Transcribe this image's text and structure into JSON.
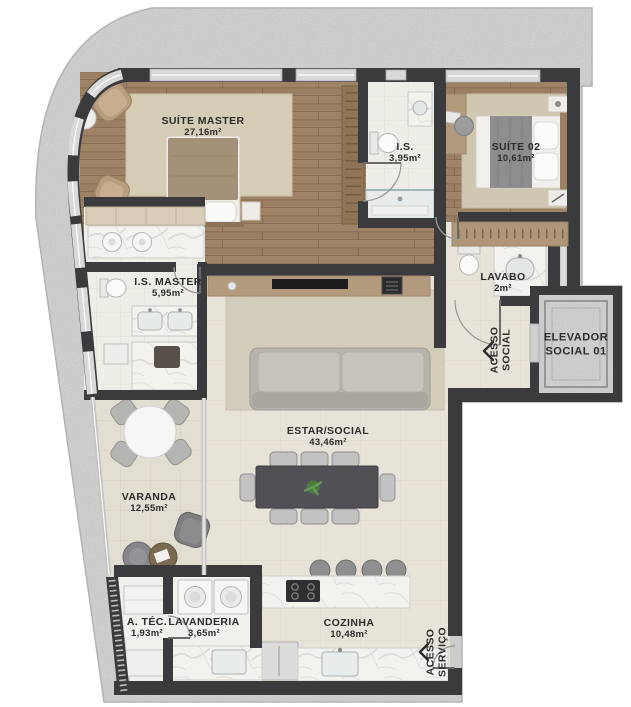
{
  "rooms": {
    "suiteMaster": {
      "name": "SUÍTE MASTER",
      "area": "27,16m²"
    },
    "isSuite": {
      "name": "I.S.",
      "area": "3,95m²"
    },
    "suite02": {
      "name": "SUÍTE 02",
      "area": "10,61m²"
    },
    "isMaster": {
      "name": "I.S. MASTER",
      "area": "5,95m²"
    },
    "lavabo": {
      "name": "LAVABO",
      "area": "2m²"
    },
    "estarSocial": {
      "name": "ESTAR/SOCIAL",
      "area": "43,46m²"
    },
    "varanda": {
      "name": "VARANDA",
      "area": "12,55m²"
    },
    "aTec": {
      "name": "A. TÉC.",
      "area": "1,93m²"
    },
    "lavanderia": {
      "name": "LAVANDERIA",
      "area": "3,65m²"
    },
    "cozinha": {
      "name": "COZINHA",
      "area": "10,48m²"
    }
  },
  "circulation": {
    "elevador": {
      "line1": "ELEVADOR",
      "line2": "SOCIAL 01"
    },
    "acessoSocial": {
      "line1": "ACESSO",
      "line2": "SOCIAL"
    },
    "acessoServico": {
      "line1": "ACESSO",
      "line2": "SERVIÇO"
    }
  },
  "icons": {
    "entry_chevron": "entry-direction-chevron"
  },
  "colors": {
    "wall": "#3b3b3d",
    "slab_concrete": "#c9c9c9",
    "wood_floor": "#9b7f62",
    "tile_floor": "#e8e3d9",
    "bath_tile": "#eeede8",
    "marble": "#f3f2ef",
    "rug": "#d6cdb6",
    "wood_furniture": "#b29a7c",
    "label_text": "#2e2c2b",
    "window_glass": "#d9d9d9"
  }
}
